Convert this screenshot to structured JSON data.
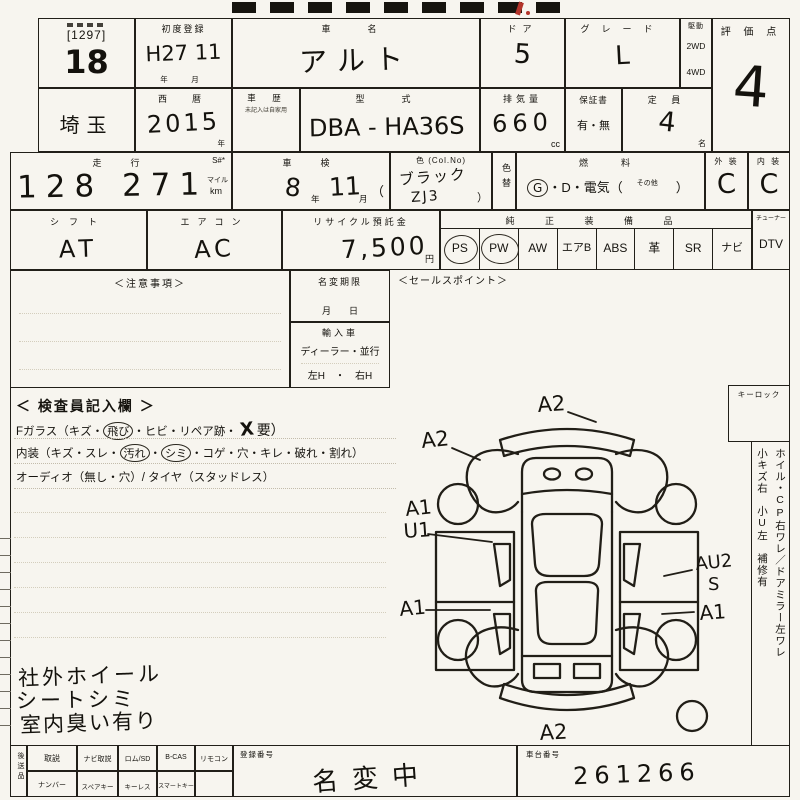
{
  "colors": {
    "line": "#211f19",
    "paper": "#f7f5ef",
    "red_mark": "#b3342a"
  },
  "lot": {
    "bracket": "[1297]",
    "number": "18"
  },
  "first_reg": {
    "label": "初度登録",
    "value": "H27 11",
    "units": "年　月"
  },
  "car": {
    "label": "車　名",
    "value": "アルト"
  },
  "doors": {
    "label": "ドア",
    "value": "5"
  },
  "grade": {
    "label": "グレード",
    "value": "L"
  },
  "drive": {
    "label": "駆動",
    "opt1": "2WD",
    "opt2": "4WD"
  },
  "score": {
    "label": "評 価 点",
    "value": "4"
  },
  "pref": {
    "value": "埼玉"
  },
  "year": {
    "label": "西　暦",
    "value": "2015",
    "unit": "年"
  },
  "history": {
    "label": "車　歴",
    "note": "未記入は自家用"
  },
  "model": {
    "label": "型　式",
    "value": "DBA - HA36S"
  },
  "disp": {
    "label": "排気量",
    "value": "660",
    "unit": "cc"
  },
  "warranty": {
    "label": "保証書",
    "value": "有・無"
  },
  "capacity": {
    "label": "定 員",
    "value": "4",
    "unit": "名"
  },
  "mileage": {
    "label": "走　行",
    "s": "S#*",
    "value": "128 271",
    "unit1": "マイル",
    "unit2": "km"
  },
  "inspection": {
    "label": "車　検",
    "y": "8",
    "y_unit": "年",
    "m": "11",
    "m_unit": "月",
    "paren": "（"
  },
  "color_box": {
    "label": "色 (Col.No)",
    "value": "ブラック",
    "code": "ZJ3",
    "paren": "）",
    "recolor": "色替"
  },
  "fuel": {
    "label": "燃　料",
    "g": "G",
    "rest": "・D・電気（",
    "other": "その他",
    "close": "）"
  },
  "exterior": {
    "label": "外 装",
    "value": "C"
  },
  "interior": {
    "label": "内 装",
    "value": "C"
  },
  "shift": {
    "label": "シフト",
    "value": "AT"
  },
  "aircon": {
    "label": "エアコン",
    "value": "AC"
  },
  "recycle": {
    "label": "リサイクル預託金",
    "value": "7,500",
    "unit": "円"
  },
  "equipment": {
    "label": "純 正 装 備 品",
    "items": [
      {
        "label": "PS",
        "circled": true
      },
      {
        "label": "PW",
        "circled": true
      },
      {
        "label": "AW",
        "circled": false
      },
      {
        "label": "エアB",
        "circled": false
      },
      {
        "label": "ABS",
        "circled": false
      },
      {
        "label": "革",
        "circled": false
      },
      {
        "label": "SR",
        "circled": false
      },
      {
        "label": "ナビ",
        "circled": false
      }
    ],
    "tuner": "チューナー",
    "dtv": "DTV"
  },
  "caution": {
    "label": "＜注意事項＞"
  },
  "name_change": {
    "label": "名変期限",
    "units": "月　　日"
  },
  "import_car": {
    "label": "輸入車",
    "line1": "ディーラー・並行",
    "line2": "左H　・　右H"
  },
  "sales": {
    "label": "＜セールスポイント＞"
  },
  "inspector": {
    "heading": "＜ 検査員記入欄 ＞",
    "l1a": "Fガラス（キズ・",
    "l1c": "飛び",
    "l1b": "・ヒビ・リペア跡・",
    "l1x": "X",
    "l1d": "要）",
    "l2a": "内装（キズ・スレ・",
    "l2c1": "汚れ",
    "l2b": "・",
    "l2c2": "シミ",
    "l2d": "・コゲ・穴・キレ・破れ・割れ）",
    "l3": "オーディオ（無し・穴）/ タイヤ（スタッドレス）"
  },
  "hand_notes": {
    "n1": "社外ホイール",
    "n2": "シートシミ",
    "n3": "室内臭い有り"
  },
  "keylock": {
    "label": "キーロック"
  },
  "right_notes": {
    "col1": "ホイル・CP右ワレ／ドアミラー左ワレ",
    "col2": "小キズ右　小U左　補修有"
  },
  "diagram": {
    "front": "A2",
    "front_left": "A2",
    "left_a1": "A1",
    "left_u1": "U1",
    "left_rear_a1": "A1",
    "right_au2": "AU2",
    "right_s": "S",
    "right_a1": "A1",
    "rear": "A2"
  },
  "bottom": {
    "side": "後送品",
    "r1c1": "取説",
    "r1c2": "ナビ取説",
    "r1c3": "ロム/SD",
    "r1c4": "B-CAS",
    "r1c5": "リモコン",
    "r2c1": "ナンバー",
    "r2c2": "スペアキー",
    "r2c3": "キーレス",
    "r2c4": "スマートキー",
    "reg_label": "登録番号",
    "reg_value": "名変中",
    "vin_label": "車台番号",
    "vin_value": "261266"
  }
}
